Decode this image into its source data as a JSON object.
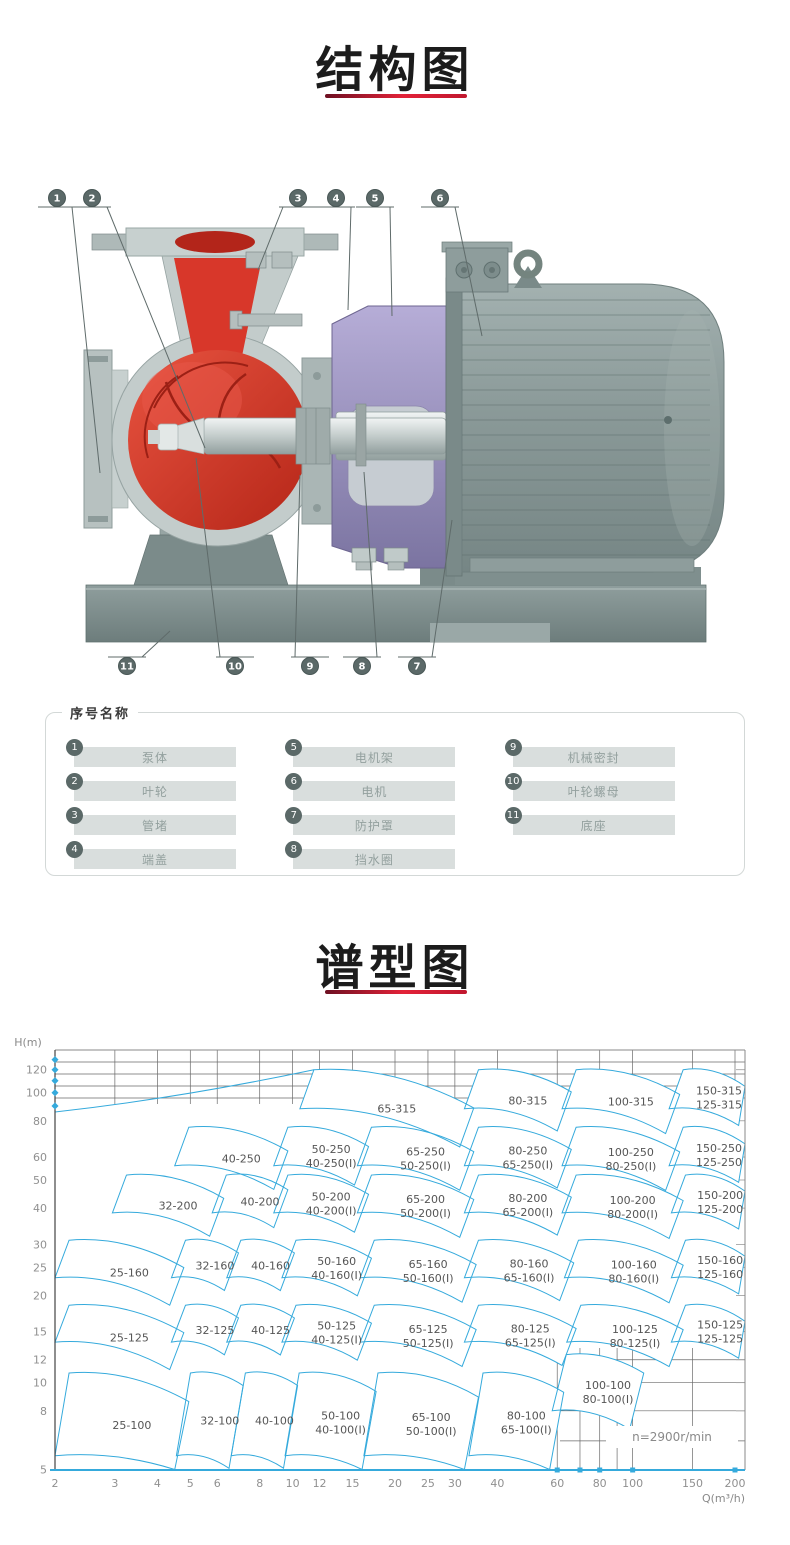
{
  "sections": {
    "structure": {
      "title": "结构图"
    },
    "spectrum": {
      "title": "谱型图"
    }
  },
  "diagram": {
    "callouts_top": [
      "1",
      "2",
      "3",
      "4",
      "5",
      "6"
    ],
    "callouts_bottom": [
      "11",
      "10",
      "9",
      "8",
      "7"
    ]
  },
  "legend": {
    "title": "序号名称",
    "items": [
      {
        "num": "1",
        "name": "泵体"
      },
      {
        "num": "2",
        "name": "叶轮"
      },
      {
        "num": "3",
        "name": "管堵"
      },
      {
        "num": "4",
        "name": "端盖"
      },
      {
        "num": "5",
        "name": "电机架"
      },
      {
        "num": "6",
        "name": "电机"
      },
      {
        "num": "7",
        "name": "防护罩"
      },
      {
        "num": "8",
        "name": "挡水圈"
      },
      {
        "num": "9",
        "name": "机械密封"
      },
      {
        "num": "10",
        "name": "叶轮螺母"
      },
      {
        "num": "11",
        "name": "底座"
      }
    ]
  },
  "chart_data": {
    "type": "area",
    "title": "谱型图",
    "xlabel": "Q(m³/h)",
    "ylabel": "H(m)",
    "x_scale": "log",
    "y_scale": "log",
    "xlim": [
      2,
      210
    ],
    "ylim": [
      5,
      140
    ],
    "x_ticks": [
      2,
      3,
      4,
      5,
      6,
      8,
      10,
      12,
      15,
      20,
      25,
      30,
      40,
      60,
      80,
      100,
      150,
      200
    ],
    "y_ticks": [
      5,
      8,
      10,
      12,
      15,
      20,
      25,
      30,
      40,
      50,
      60,
      80,
      100,
      120
    ],
    "annotation": "n=2900r/min",
    "grid": "partial",
    "legend_position": "none",
    "accent_color": "#35aadc",
    "tiles": [
      {
        "labels": [
          "65-315"
        ],
        "q": [
          10.5,
          31
        ],
        "h": [
          120,
          88
        ]
      },
      {
        "labels": [
          "80-315"
        ],
        "q": [
          32,
          60
        ],
        "h": [
          120,
          88
        ]
      },
      {
        "labels": [
          "100-315"
        ],
        "q": [
          62,
          125
        ],
        "h": [
          120,
          88
        ]
      },
      {
        "labels": [
          "150-315",
          "125-315"
        ],
        "q": [
          128,
          205
        ],
        "h": [
          120,
          88
        ]
      },
      {
        "labels": [
          "40-250"
        ],
        "q": [
          4.5,
          8.8
        ],
        "h": [
          76,
          56
        ]
      },
      {
        "labels": [
          "50-250",
          "40-250(I)"
        ],
        "q": [
          8.8,
          15.2
        ],
        "h": [
          76,
          56
        ]
      },
      {
        "labels": [
          "65-250",
          "50-250(I)"
        ],
        "q": [
          15.5,
          31
        ],
        "h": [
          76,
          56
        ]
      },
      {
        "labels": [
          "80-250",
          "65-250(I)"
        ],
        "q": [
          32,
          60
        ],
        "h": [
          76,
          56
        ]
      },
      {
        "labels": [
          "100-250",
          "80-250(I)"
        ],
        "q": [
          62,
          125
        ],
        "h": [
          76,
          56
        ]
      },
      {
        "labels": [
          "150-250",
          "125-250"
        ],
        "q": [
          128,
          205
        ],
        "h": [
          76,
          56
        ]
      },
      {
        "labels": [
          "32-200"
        ],
        "q": [
          2.95,
          5.7
        ],
        "h": [
          52,
          38.5
        ]
      },
      {
        "labels": [
          "40-200"
        ],
        "q": [
          5.8,
          8.8
        ],
        "h": [
          52,
          38.5
        ]
      },
      {
        "labels": [
          "50-200",
          "40-200(I)"
        ],
        "q": [
          8.8,
          15.2
        ],
        "h": [
          52,
          38.5
        ]
      },
      {
        "labels": [
          "65-200",
          "50-200(I)"
        ],
        "q": [
          15.5,
          31
        ],
        "h": [
          52,
          38.5
        ]
      },
      {
        "labels": [
          "80-200",
          "65-200(I)"
        ],
        "q": [
          32,
          60
        ],
        "h": [
          52,
          38.5
        ]
      },
      {
        "labels": [
          "100-200",
          "80-200(I)"
        ],
        "q": [
          62,
          128
        ],
        "h": [
          52,
          38.5
        ]
      },
      {
        "labels": [
          "150-200",
          "125-200"
        ],
        "q": [
          130,
          205
        ],
        "h": [
          52,
          38.5
        ]
      },
      {
        "labels": [
          "25-160"
        ],
        "q": [
          2,
          4.35
        ],
        "h": [
          31,
          23
        ]
      },
      {
        "labels": [
          "32-160"
        ],
        "q": [
          4.4,
          6.3
        ],
        "h": [
          31,
          23
        ]
      },
      {
        "labels": [
          "40-160"
        ],
        "q": [
          6.4,
          9.2
        ],
        "h": [
          31,
          23
        ]
      },
      {
        "labels": [
          "50-160",
          "40-160(I)"
        ],
        "q": [
          9.3,
          15.5
        ],
        "h": [
          31,
          23
        ]
      },
      {
        "labels": [
          "65-160",
          "50-160(I)"
        ],
        "q": [
          15.8,
          31.5
        ],
        "h": [
          31,
          23
        ]
      },
      {
        "labels": [
          "80-160",
          "65-160(I)"
        ],
        "q": [
          32,
          61
        ],
        "h": [
          31,
          23
        ]
      },
      {
        "labels": [
          "100-160",
          "80-160(I)"
        ],
        "q": [
          63,
          128
        ],
        "h": [
          31,
          23
        ]
      },
      {
        "labels": [
          "150-160",
          "125-160"
        ],
        "q": [
          130,
          205
        ],
        "h": [
          31,
          23
        ]
      },
      {
        "labels": [
          "25-125"
        ],
        "q": [
          2,
          4.35
        ],
        "h": [
          18.5,
          13.8
        ]
      },
      {
        "labels": [
          "32-125"
        ],
        "q": [
          4.4,
          6.3
        ],
        "h": [
          18.5,
          13.8
        ]
      },
      {
        "labels": [
          "40-125"
        ],
        "q": [
          6.4,
          9.2
        ],
        "h": [
          18.5,
          13.8
        ]
      },
      {
        "labels": [
          "50-125",
          "40-125(I)"
        ],
        "q": [
          9.3,
          15.5
        ],
        "h": [
          18.5,
          13.8
        ]
      },
      {
        "labels": [
          "65-125",
          "50-125(I)"
        ],
        "q": [
          15.8,
          31.5
        ],
        "h": [
          18.5,
          13.8
        ]
      },
      {
        "labels": [
          "80-125",
          "65-125(I)"
        ],
        "q": [
          32,
          62
        ],
        "h": [
          18.5,
          13.8
        ]
      },
      {
        "labels": [
          "100-125",
          "80-125(I)"
        ],
        "q": [
          64,
          128
        ],
        "h": [
          18.5,
          13.8
        ]
      },
      {
        "labels": [
          "150-125",
          "125-125"
        ],
        "q": [
          130,
          205
        ],
        "h": [
          18.5,
          13.8
        ]
      },
      {
        "labels": [
          "25-100"
        ],
        "q": [
          2,
          4.5
        ],
        "h": [
          10.8,
          5.6
        ]
      },
      {
        "labels": [
          "32-100"
        ],
        "q": [
          4.55,
          6.5
        ],
        "h": [
          10.8,
          5.6
        ]
      },
      {
        "labels": [
          "40-100"
        ],
        "q": [
          6.6,
          9.4
        ],
        "h": [
          10.8,
          5.6
        ]
      },
      {
        "labels": [
          "50-100",
          "40-100(I)"
        ],
        "q": [
          9.5,
          16
        ],
        "h": [
          10.8,
          5.6
        ]
      },
      {
        "labels": [
          "65-100",
          "50-100(I)"
        ],
        "q": [
          16.2,
          32
        ],
        "h": [
          10.8,
          5.6
        ]
      },
      {
        "labels": [
          "80-100",
          "65-100(I)"
        ],
        "q": [
          33,
          57
        ],
        "h": [
          10.8,
          5.6
        ]
      },
      {
        "labels": [
          "100-100",
          "80-100(I)"
        ],
        "q": [
          58,
          98
        ],
        "h": [
          12.5,
          8
        ]
      }
    ]
  }
}
